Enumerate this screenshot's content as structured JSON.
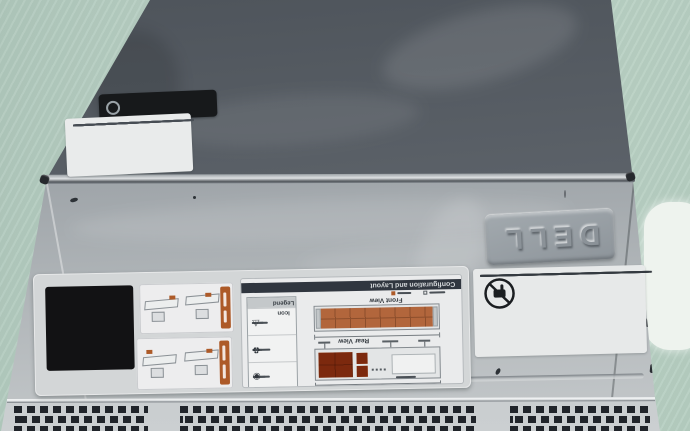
{
  "badge": {
    "brand": "DELL"
  },
  "labels": {
    "config": {
      "title": "Configuration and Layout",
      "front_view": "Front View",
      "rear_view": "Rear View",
      "legend_title": "Icon Legend"
    },
    "qrl": {
      "title": "Quick Resource Locator",
      "url": "DELL.COM/QRL"
    }
  },
  "icons": {
    "legend": [
      "⚠",
      "♻",
      "◉"
    ]
  },
  "colors": {
    "table_green": "#b9cfc2",
    "rear_cover_gray": "#5d646b",
    "front_cover_silver": "#a9afb3",
    "accent_orange": "#ad5a28",
    "drive_orange": "#b2663c",
    "qr_black": "#121214",
    "title_bar_navy": "#30363f",
    "label_white": "#e9ebeb"
  }
}
